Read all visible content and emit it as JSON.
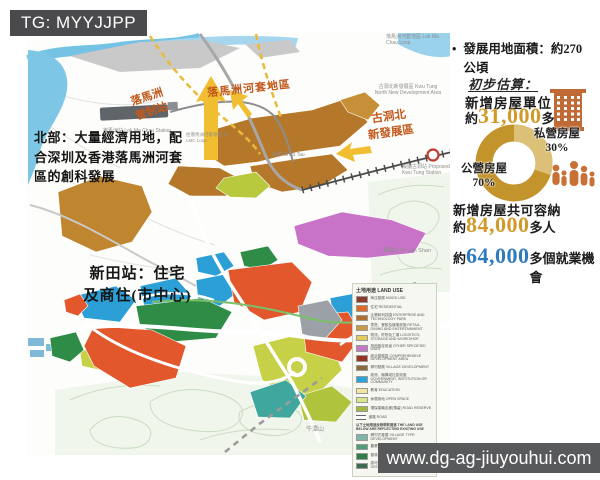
{
  "watermark_top": {
    "text": "TG: MYYJJPP"
  },
  "watermark_bottom": {
    "text": "www.dg-ag-jiuyouhui.com"
  },
  "map": {
    "annotations": {
      "north_note": "北部：大量經濟用地，配合深圳及香港落馬洲河套區的創科發展",
      "lmc_control_line1": "落馬洲",
      "lmc_control_line2": "管制站",
      "lmc_loop": "落馬洲河套地區",
      "ktn_line1": "古洞北",
      "ktn_line2": "新發展區",
      "san_tin_line1": "新田站：住宅",
      "san_tin_line2": "及商住(市中心)"
    },
    "labels": {
      "lmc_station": "落馬洲站 Lok Ma Chau Station",
      "lmc_loop_small": "落馬洲河套地區 Lok Ma Chau Loop",
      "ktn_small": "古洞北新發展區 Kwu Tung North New Development Area",
      "kt_station": "擬議古洞站 Proposed Kwu Tung Station",
      "ki_lun_shan": "麒麟山 Ki Lun Shan",
      "ngau_tam_shan": "牛潭山",
      "chau_tau": "洲頭 Chau Tau",
      "to_lmc_loop": "往落馬洲河套地區 To LMC Loop"
    },
    "legend": {
      "title": "土地用途 LAND USE",
      "items": [
        {
          "c": "#8c3a2a",
          "t": "商住發展 MIXED USE"
        },
        {
          "c": "#dd6b27",
          "t": "住宅 RESIDENTIAL"
        },
        {
          "c": "#b06f2a",
          "t": "企業和科技園 ENTERPRISE AND TECHNOLOGY PARK"
        },
        {
          "c": "#c89d42",
          "t": "零售、餐飲及娛樂設施 RETAIL, DINING AND ENTERTAINMENT"
        },
        {
          "c": "#e3cb5c",
          "t": "物流、貯物及工場 LOGISTICS, STORAGE AND WORKSHOP"
        },
        {
          "c": "#c478c4",
          "t": "其他指定用途 OTHER SPECIFIED USES"
        },
        {
          "c": "#993324",
          "t": "綜合發展區 COMPREHENSIVE DEVELOPMENT AREA"
        },
        {
          "c": "#8a6b3a",
          "t": "鄉村發展 VILLAGE DEVELOPMENT"
        },
        {
          "c": "#29a3dc",
          "t": "政府、機構或社區設施 GOVERNMENT, INSTITUTION OR COMMUNITY"
        },
        {
          "c": "#f2e6a0",
          "t": "教育 EDUCATION"
        },
        {
          "c": "#d8e68a",
          "t": "休憩用地 OPEN SPACE"
        },
        {
          "c": "#a3b83c",
          "t": "環保運輸走廊(預留) ROAD RESERVE"
        },
        {
          "c": "line",
          "t": "道路 ROAD"
        },
        {
          "header": "以下土地用途反映現有用途 THE LAND USE BELOW ARE REFLECTING EXISTING USE"
        },
        {
          "c": "#7fb5a8",
          "t": "鄉村式發展 VILLAGE TYPE DEVELOPMENT"
        },
        {
          "c": "#4e9e77",
          "t": "農業 AGRICULTURE"
        },
        {
          "c": "#2e7d46",
          "t": "樹林 WOODLAND"
        },
        {
          "c": "#3c6b4f",
          "t": "認可殯葬區 PERMITTED BURIAL GROUND"
        }
      ]
    }
  },
  "stats_panel": {
    "area_bullet_line1": "發展用地面積：約270",
    "area_bullet_line2": "公頃",
    "estimate_heading": "初步估算：",
    "housing_label": "新增房屋單位",
    "housing_prefix": "約",
    "housing_value": "31,000",
    "housing_suffix": "多個",
    "private_label": "私營房屋",
    "private_pct": "30%",
    "public_label": "公營房屋",
    "public_pct": "70%",
    "capacity_label": "新增房屋共可容納",
    "capacity_prefix": "約",
    "capacity_value": "84,000",
    "capacity_suffix": "多人",
    "jobs_prefix": "約",
    "jobs_value": "64,000",
    "jobs_suffix": "多個就業機會",
    "accent_gold": "#d29a2a",
    "accent_blue": "#2d7bbf",
    "icon_colors": {
      "building": "#c06a35",
      "people": "#c87137"
    }
  },
  "chart_data": {
    "type": "pie",
    "labels": [
      "公營房屋",
      "私營房屋"
    ],
    "values": [
      70,
      30
    ],
    "colors": [
      "#c3932c",
      "#dcc077"
    ],
    "legend_position": "sides"
  }
}
